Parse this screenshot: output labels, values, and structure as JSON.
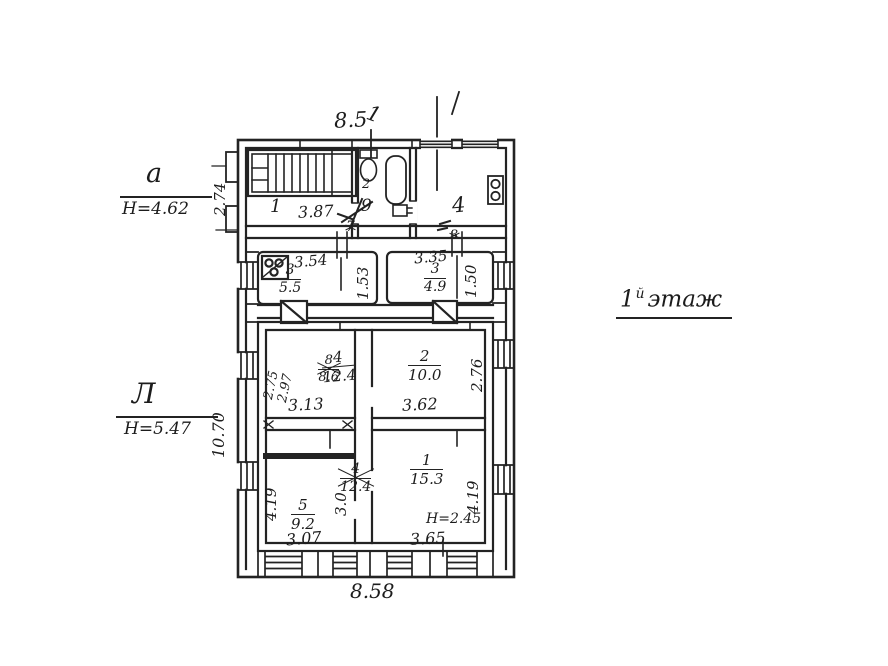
{
  "page": {
    "bg": "#ffffff",
    "ink": "#232323"
  },
  "annotations": {
    "dim_top": "8.5",
    "dim_top_tick": "1",
    "dim_bottom": "8.58",
    "dim_left_top_block": "2.74",
    "dim_left_main": "10.70",
    "litera_top": {
      "letter": "а",
      "height": "H=4.62"
    },
    "litera_main": {
      "letter": "Л",
      "height": "H=5.47"
    },
    "floor": {
      "number": "1",
      "sup": "й",
      "word": "этаж"
    }
  },
  "top_block": {
    "room1": {
      "number": "1",
      "width": "3.87"
    },
    "bath": {
      "number": "2",
      "scribble_old": "7",
      "scribble_new": "9"
    },
    "kitchen": {
      "number_old": "3",
      "number_new": "4"
    }
  },
  "strip": {
    "left": {
      "width": "3.54",
      "room": "3",
      "area": "5.5",
      "depth": "1.53"
    },
    "right": {
      "width": "3.35",
      "room": "3",
      "area": "4.9",
      "depth": "1.50"
    }
  },
  "main": {
    "upper_left": {
      "dim_v1": "2.75",
      "dim_v2": "2.97",
      "room_old": "8",
      "area_old": "8.6",
      "room": "4",
      "area": "12.4",
      "width": "3.13"
    },
    "upper_right": {
      "room": "2",
      "area": "10.0",
      "width": "3.62",
      "depth": "2.76"
    },
    "lower_left": {
      "depth": "4.19",
      "room_old": "4",
      "area_old": "12.4",
      "room": "5",
      "area": "9.2",
      "inner_depth": "3.0",
      "width": "3.07"
    },
    "lower_right": {
      "room": "1",
      "area": "15.3",
      "height_note": "H=2.45",
      "width": "3.65",
      "depth": "4.19"
    }
  },
  "fixtures": {
    "staircase": "stairs",
    "toilet": "toilet",
    "bathtub": "bathtub",
    "sink": "sink",
    "stove": "stove",
    "flue": "ventilation-flue",
    "window": "window"
  }
}
